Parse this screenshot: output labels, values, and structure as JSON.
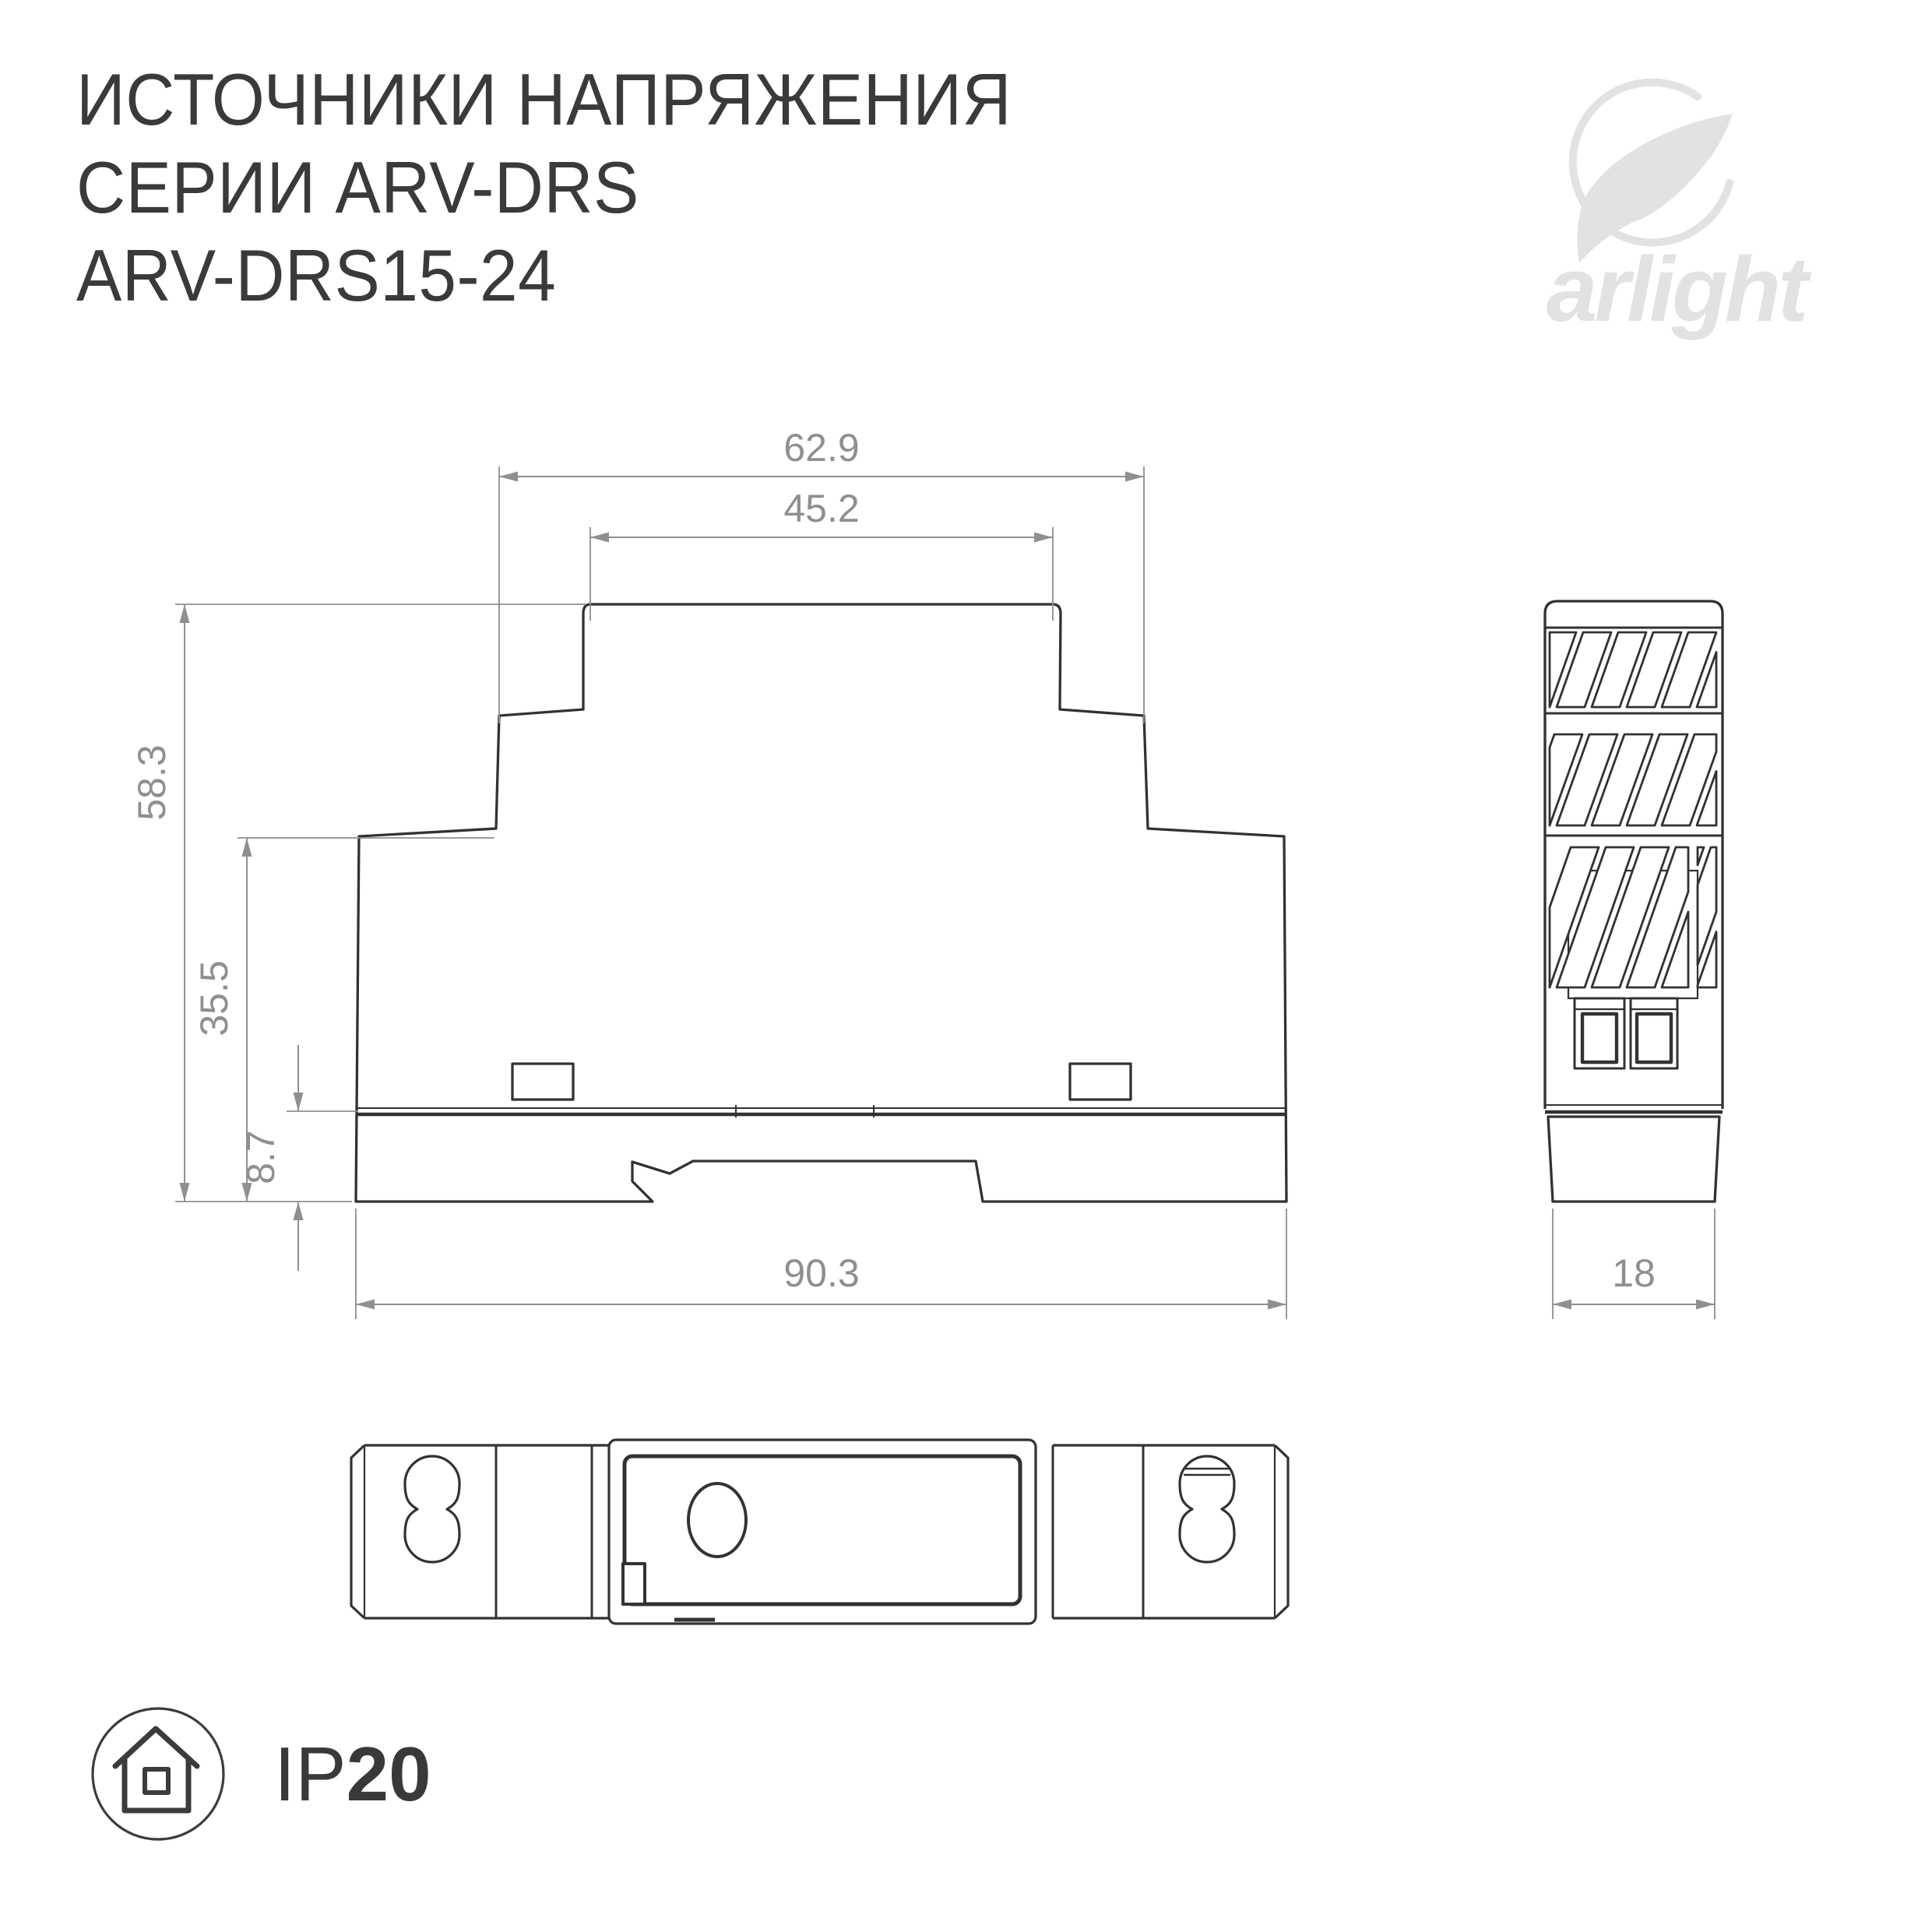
{
  "title": {
    "line1": "ИСТОЧНИКИ НАПРЯЖЕНИЯ",
    "line2": "СЕРИИ ARV-DRS",
    "line3": "ARV-DRS15-24"
  },
  "logo": {
    "text": "arlight",
    "icon": "arlight-swoosh-icon"
  },
  "views": {
    "front": {
      "dims": {
        "top_width": "62.9",
        "cap_width": "45.2",
        "total_height": "58.3",
        "mid_height": "35.5",
        "base_height": "8.7",
        "total_width": "90.3"
      }
    },
    "side": {
      "dims": {
        "width": "18"
      }
    },
    "bottom": {}
  },
  "badge": {
    "ip_prefix": "IP",
    "ip_value": "20",
    "icon": "house-in-circle-icon"
  },
  "colors": {
    "line": "#323236",
    "dim": "#8f8f8f",
    "logo": "#e2e2e2",
    "text": "#3a3a3c"
  }
}
